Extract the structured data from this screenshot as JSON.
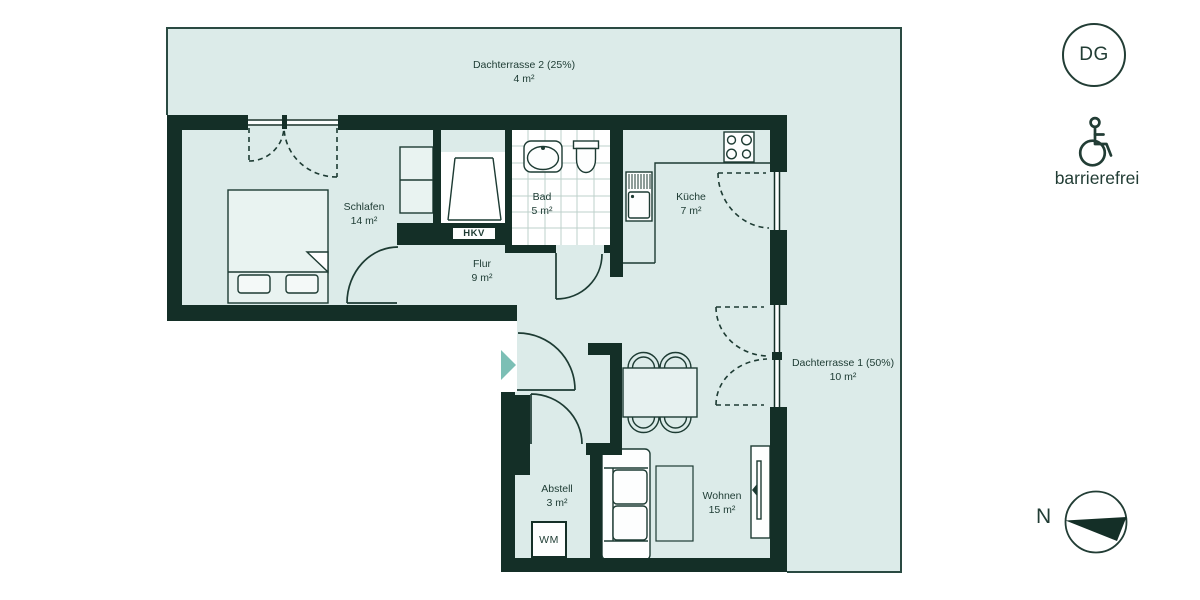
{
  "colors": {
    "wall": "#142f27",
    "floor": "#dcebe9",
    "line": "#1d3b33",
    "tile_line": "#bdd0cb",
    "entry_arrow_teal": "#7cbfb5",
    "fixture_white": "#fdfefe"
  },
  "plan": {
    "rooms": [
      {
        "id": "dachterrasse2",
        "label": "Dachterrasse 2 (25%)",
        "area": "4 m²"
      },
      {
        "id": "schlafen",
        "label": "Schlafen",
        "area": "14 m²"
      },
      {
        "id": "bad",
        "label": "Bad",
        "area": "5 m²"
      },
      {
        "id": "kueche",
        "label": "Küche",
        "area": "7 m²"
      },
      {
        "id": "flur",
        "label": "Flur",
        "area": "9 m²"
      },
      {
        "id": "dachterrasse1",
        "label": "Dachterrasse 1 (50%)",
        "area": "10 m²"
      },
      {
        "id": "abstell",
        "label": "Abstell",
        "area": "3 m²"
      },
      {
        "id": "wohnen",
        "label": "Wohnen",
        "area": "15 m²"
      }
    ],
    "fixtures": {
      "hkv_label": "HKV",
      "wm_label": "WM"
    }
  },
  "legend": {
    "floor_badge": "DG",
    "accessibility_label": "barrierefrei",
    "compass_north": "N"
  }
}
